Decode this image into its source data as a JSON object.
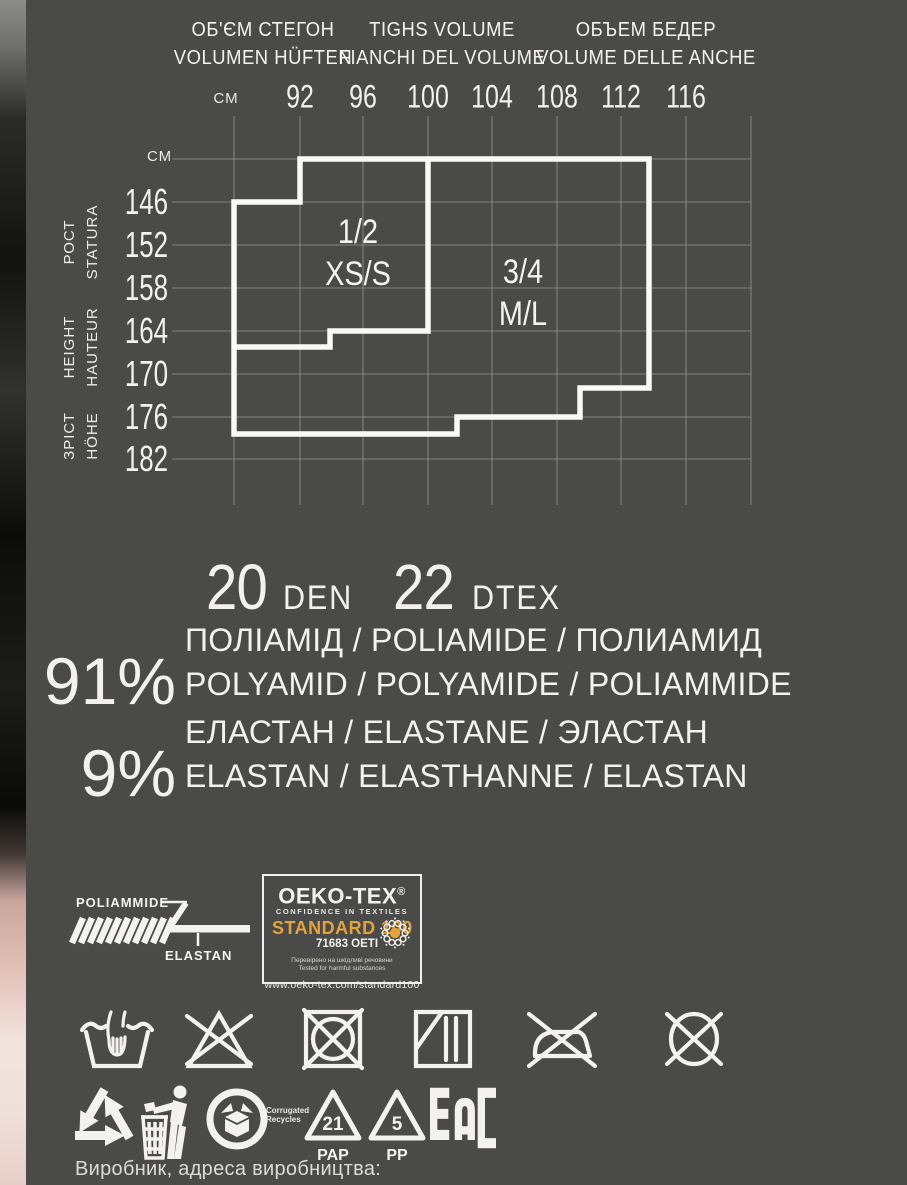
{
  "page": {
    "background": "#4a4a48",
    "text_color": "#f2f1ed",
    "accent_orange": "#e5a33c"
  },
  "header": {
    "columns": [
      {
        "line1": "ОБ'ЄМ СТЕГОН",
        "line2": "VOLUMEN HÜFTEN"
      },
      {
        "line1": "TIGHS VOLUME",
        "line2": "FIANCHI DEL VOLUME"
      },
      {
        "line1": "ОБЪЕМ БЕДЕР",
        "line2": "VOLUME DELLE ANCHE"
      }
    ],
    "unit": "СМ"
  },
  "chart_data": {
    "type": "size-grid",
    "title": "tights size selection chart",
    "x_axis": {
      "unit": "СМ",
      "label": "hip volume"
    },
    "x_values": [
      "92",
      "96",
      "100",
      "104",
      "108",
      "112",
      "116"
    ],
    "y_axis": {
      "unit": "СМ",
      "label": "height"
    },
    "y_values": [
      "146",
      "152",
      "158",
      "164",
      "170",
      "176",
      "182"
    ],
    "y_axis_captions": [
      {
        "line1": "РОСТ",
        "line2": "STATURA"
      },
      {
        "line1": "HEIGHT",
        "line2": "HAUTEUR"
      },
      {
        "line1": "ЗРІСТ",
        "line2": "HÖHE"
      }
    ],
    "regions": [
      {
        "id": "size-1-2-xs-s",
        "lines": [
          "1/2",
          "XS/S"
        ],
        "x": 358,
        "ys": [
          243,
          285
        ]
      },
      {
        "id": "size-3-4-m-l",
        "lines": [
          "3/4",
          "M/L"
        ],
        "x": 523,
        "ys": [
          283,
          325
        ]
      }
    ],
    "geometry": {
      "cols": [
        234,
        300,
        363,
        428,
        492,
        557,
        621,
        686,
        751
      ],
      "rows": [
        159,
        202,
        245,
        288,
        331,
        374,
        417,
        459
      ],
      "grid_x": [
        172,
        751
      ],
      "grid_y": [
        116,
        505
      ],
      "outer": "300,159 649,159 649,388 580,388 580,417 457,417 457,434 234,434 234,202 300,202",
      "divider": "428,159 428,331 330,331 330,347 234,347"
    }
  },
  "den": {
    "value1": "20",
    "unit1": "DEN",
    "value2": "22",
    "unit2": "DTEX"
  },
  "composition": [
    {
      "pct": "91%",
      "line1": "ПОЛІАМІД / POLIAMIDE / ПОЛИАМИД",
      "line2": "POLYAMID / POLYAMIDE / POLIAMMIDE"
    },
    {
      "pct": "9%",
      "line1": "ЕЛАСТАН / ELASTANE / ЭЛАСТАН",
      "line2": "ELASTAN / ELASTHANNE / ELASTAN"
    }
  ],
  "fiber_diagram": {
    "outer": "POLIAMMIDE",
    "core": "ELASTAN"
  },
  "oekotex": {
    "brand": "OEKO-TEX",
    "reg": "®",
    "tagline": "CONFIDENCE IN TEXTILES",
    "standard": "STANDARD 100",
    "certificate": "71683 OETI",
    "note1": "Перевірено на шкідливі речовини",
    "note2": "Tested for harmful substances",
    "url": "www.oeko-tex.com/standard100"
  },
  "care_symbols": [
    "hand-wash",
    "do-not-bleach",
    "do-not-tumble-dry",
    "drip-dry-in-shade",
    "do-not-iron",
    "do-not-dry-clean"
  ],
  "recycling": {
    "mobius": "recycling-arrows",
    "tidy_man": "dispose-properly",
    "corrugated_line1": "Corrugated",
    "corrugated_line2": "Recycles",
    "pap_num": "21",
    "pap_label": "PAP",
    "pp_num": "5",
    "pp_label": "PP",
    "eac": "EAC"
  },
  "footer": {
    "producer_label": "Виробник, адреса виробництва:"
  }
}
